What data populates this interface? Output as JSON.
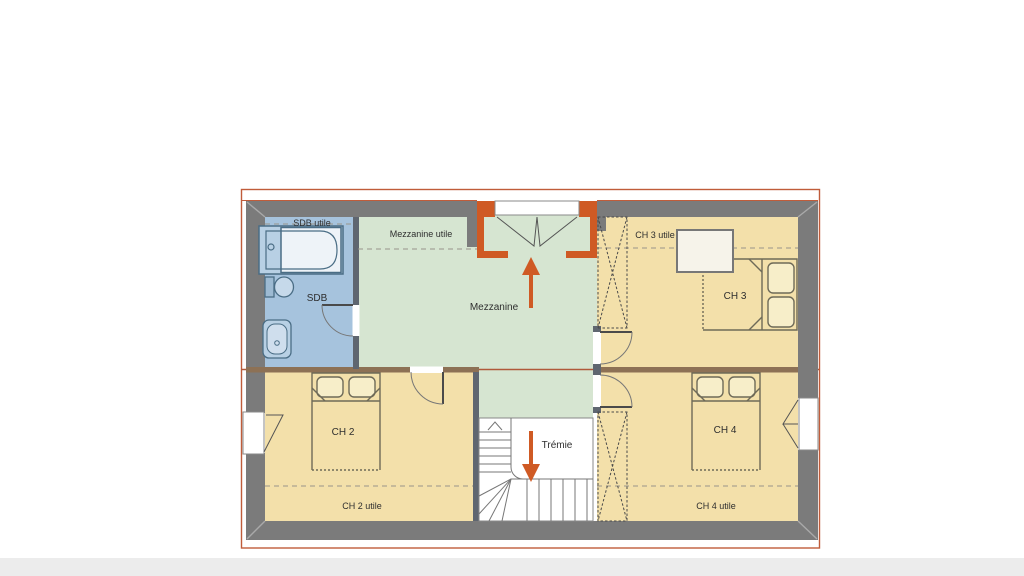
{
  "plan": {
    "title_context": "floor-plan-upper-level",
    "labels": {
      "sdb_utile": "SDB utile",
      "mezzanine_utile": "Mezzanine utile",
      "ch3_utile": "CH 3 utile",
      "sdb": "SDB",
      "mezzanine": "Mezzanine",
      "ch3": "CH 3",
      "ch2": "CH 2",
      "tremie": "Trémie",
      "ch4": "CH 4",
      "ch2_utile": "CH 2 utile",
      "ch4_utile": "CH 4 utile"
    },
    "colors": {
      "wall_gray": "#7b7b7b",
      "bedroom_floor": "#f3e0aa",
      "mezzanine_floor": "#d6e5d1",
      "bathroom_floor": "#a6c3dd",
      "dormer_accent": "#cf5a24",
      "arrow_accent": "#cf5a24",
      "roof_outline": "#c05c3a",
      "ridge_wall_brown": "#8d7155",
      "stair_white": "#ffffff",
      "fixture_blue": "#4a6d85"
    }
  }
}
